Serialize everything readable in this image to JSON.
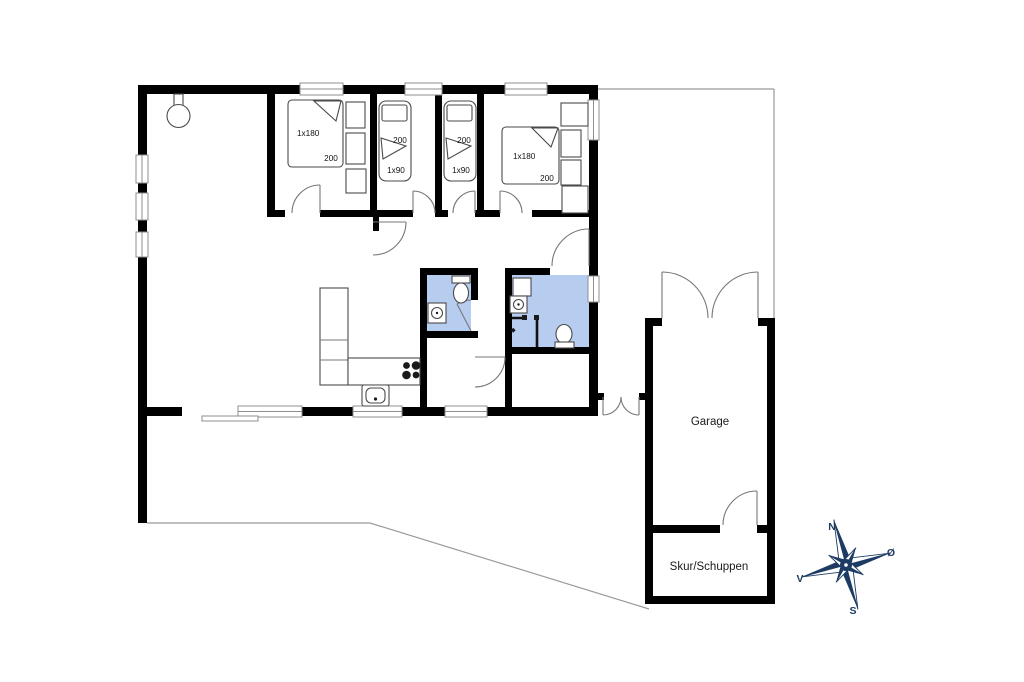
{
  "floor_plan": {
    "bedrooms": [
      {
        "bed_size": "1x180",
        "bed_length": "200"
      },
      {
        "bed_size": "1x90",
        "bed_length": "200"
      },
      {
        "bed_size": "1x90",
        "bed_length": "200"
      },
      {
        "bed_size": "1x180",
        "bed_length": "200"
      }
    ],
    "garage_label": "Garage",
    "shed_label": "Skur/Schuppen",
    "compass": {
      "north": "N",
      "east": "Ø",
      "south": "S",
      "west": "V"
    },
    "colors": {
      "walls": "#000000",
      "bathroom_fill": "#b7cdef",
      "compass_navy": "#1d3b63",
      "window_stroke": "#8f8f8f",
      "door_arc": "#777777",
      "boundary_line": "#9a9a9a"
    }
  }
}
